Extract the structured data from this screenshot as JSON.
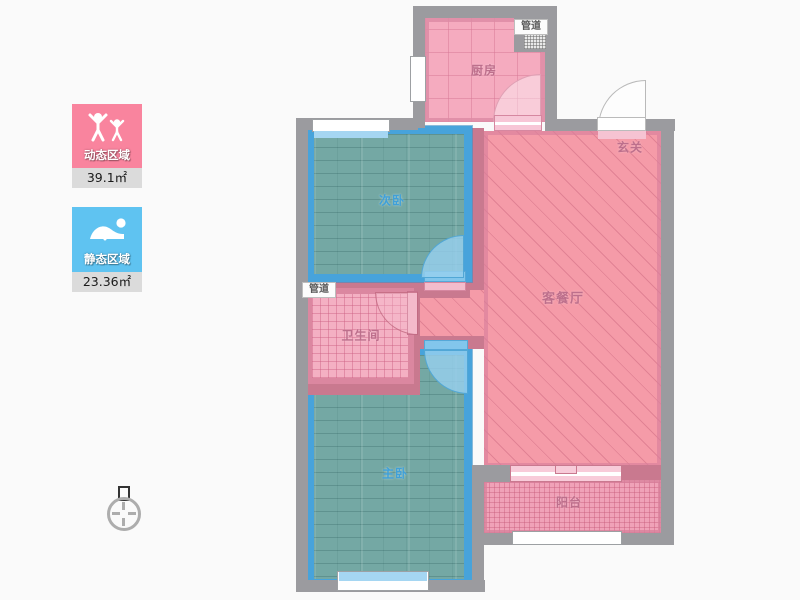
{
  "title": "residential floor plan",
  "rooms": {
    "kitchen": {
      "label": "厨房"
    },
    "hallway": {
      "label": "玄关"
    },
    "living_dining": {
      "label": "客餐厅"
    },
    "second_bedroom": {
      "label": "次卧"
    },
    "bathroom": {
      "label": "卫生间"
    },
    "master_bedroom": {
      "label": "主卧"
    },
    "balcony": {
      "label": "阳台"
    },
    "pipe_duct_kitchen": {
      "label": "管道"
    },
    "pipe_duct_bathroom": {
      "label": "管道"
    }
  },
  "legend": {
    "dynamic_zone": {
      "label": "动态区域",
      "area": "39.1㎡",
      "color": "#F9849E",
      "icon": "standing-people-icon"
    },
    "static_zone": {
      "label": "静态区域",
      "area": "23.36㎡",
      "color": "#5FC3F1",
      "icon": "sleeping-person-icon"
    }
  },
  "icons": [
    "standing-people-icon",
    "sleeping-person-icon",
    "compass-icon"
  ],
  "colors": {
    "background": "#FAFAFA",
    "outer_wall_gray": "#9B9B9F",
    "inner_wall_pink": "#C9798F",
    "living_floor": "#F59BA8",
    "kitchen_floor": "#F5ABBF",
    "bathroom_floor": "#F4B0C3",
    "balcony_floor": "#F0A2B8",
    "bedroom_floor_teal": "#74A8A4",
    "bedroom_border_blue": "#47A3DB",
    "door_arc_blue": "#82C6EC",
    "legend_value_strip": "#DBDBDB"
  }
}
